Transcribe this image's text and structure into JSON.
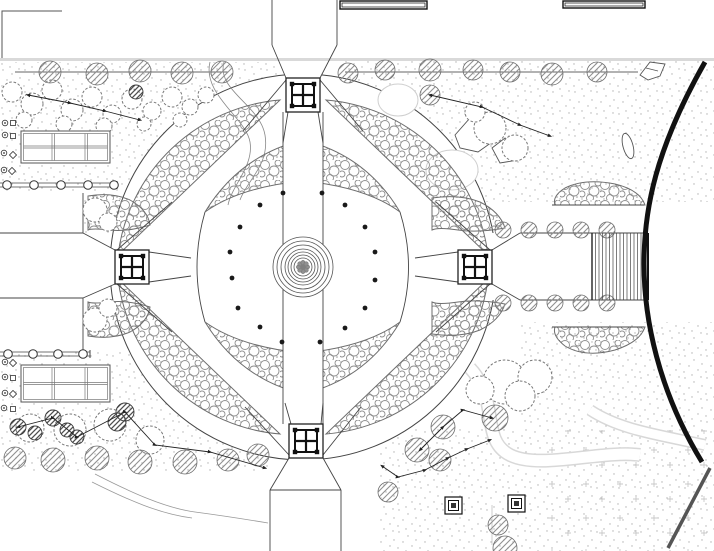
{
  "canvas": {
    "width": 714,
    "height": 551,
    "background": "#ffffff"
  },
  "palette": {
    "line": "#333333",
    "path_edge": "#444444",
    "veg_stroke": "#6e6e6e",
    "veg_circle": "#8f8f8f",
    "stipple": "#b0b0b0",
    "road": "#111111",
    "wall_gray": "#d9d9d9",
    "dark": "#1a1a1a",
    "cloud_stroke": "#787878"
  },
  "fountain": {
    "cx": 303,
    "cy": 267,
    "rings": [
      30,
      26,
      22,
      18,
      15,
      12,
      9
    ],
    "core_r": 4.5,
    "core_dot_r": 2.2
  },
  "plaza_dots": [
    [
      283,
      193
    ],
    [
      260,
      205
    ],
    [
      240,
      227
    ],
    [
      230,
      252
    ],
    [
      232,
      278
    ],
    [
      238,
      308
    ],
    [
      260,
      327
    ],
    [
      282,
      342
    ],
    [
      322,
      193
    ],
    [
      345,
      205
    ],
    [
      365,
      227
    ],
    [
      375,
      252
    ],
    [
      375,
      280
    ],
    [
      365,
      308
    ],
    [
      345,
      328
    ],
    [
      320,
      342
    ]
  ],
  "pavilions": [
    {
      "cx": 303,
      "cy": 95
    },
    {
      "cx": 132,
      "cy": 267
    },
    {
      "cx": 475,
      "cy": 267
    },
    {
      "cx": 306,
      "cy": 441
    }
  ],
  "pavilion_size": 34,
  "pergolas": [
    {
      "x": 21,
      "y": 131,
      "w": 89,
      "h": 32
    },
    {
      "x": 21,
      "y": 365,
      "w": 89,
      "h": 37
    }
  ],
  "colonnades": [
    {
      "y": 183,
      "x0": 0,
      "x1": 117,
      "posts": [
        7,
        34,
        61,
        88,
        114
      ]
    },
    {
      "y": 352,
      "x0": 0,
      "x1": 90,
      "posts": [
        8,
        33,
        58,
        83
      ]
    }
  ],
  "top_structures": [
    {
      "x": 340,
      "y": 1,
      "w": 87,
      "h": 8
    },
    {
      "x": 563,
      "y": 1,
      "w": 82,
      "h": 7
    }
  ],
  "planters": [
    {
      "x": 445,
      "y": 497,
      "s": 17
    },
    {
      "x": 508,
      "y": 495,
      "s": 17
    }
  ],
  "stairs": {
    "x0": 592,
    "x1": 648,
    "y0": 233,
    "y1": 300,
    "step": 3.5
  },
  "trees": [
    [
      50,
      72,
      11
    ],
    [
      97,
      74,
      11
    ],
    [
      140,
      71,
      11
    ],
    [
      182,
      73,
      11
    ],
    [
      222,
      72,
      11
    ],
    [
      348,
      73,
      10
    ],
    [
      385,
      70,
      10
    ],
    [
      430,
      70,
      11
    ],
    [
      473,
      70,
      10
    ],
    [
      510,
      72,
      10
    ],
    [
      552,
      74,
      11
    ],
    [
      597,
      72,
      10
    ],
    [
      430,
      95,
      10
    ],
    [
      503,
      230,
      8
    ],
    [
      529,
      230,
      8
    ],
    [
      555,
      230,
      8
    ],
    [
      581,
      230,
      8
    ],
    [
      607,
      230,
      8
    ],
    [
      503,
      303,
      8
    ],
    [
      529,
      303,
      8
    ],
    [
      555,
      303,
      8
    ],
    [
      581,
      303,
      8
    ],
    [
      607,
      303,
      8
    ],
    [
      15,
      458,
      11
    ],
    [
      53,
      460,
      12
    ],
    [
      97,
      458,
      12
    ],
    [
      140,
      462,
      12
    ],
    [
      185,
      462,
      12
    ],
    [
      228,
      460,
      11
    ],
    [
      258,
      455,
      11
    ],
    [
      388,
      492,
      10
    ],
    [
      498,
      525,
      10
    ],
    [
      505,
      548,
      12
    ],
    [
      495,
      418,
      13
    ],
    [
      443,
      427,
      12
    ],
    [
      417,
      450,
      12
    ],
    [
      440,
      460,
      11
    ]
  ],
  "dark_trees": [
    [
      136,
      92,
      7
    ],
    [
      18,
      427,
      8
    ],
    [
      35,
      433,
      7
    ],
    [
      53,
      418,
      8
    ],
    [
      67,
      430,
      7
    ],
    [
      77,
      437,
      7
    ],
    [
      117,
      422,
      9
    ],
    [
      125,
      412,
      9
    ]
  ],
  "clouds": [
    [
      12,
      92,
      10
    ],
    [
      32,
      104,
      11
    ],
    [
      52,
      90,
      10
    ],
    [
      72,
      110,
      11
    ],
    [
      92,
      97,
      10
    ],
    [
      112,
      114,
      9
    ],
    [
      132,
      99,
      10
    ],
    [
      152,
      111,
      9
    ],
    [
      172,
      97,
      10
    ],
    [
      190,
      107,
      8
    ],
    [
      206,
      95,
      8
    ],
    [
      24,
      120,
      8
    ],
    [
      64,
      124,
      8
    ],
    [
      104,
      126,
      8
    ],
    [
      144,
      124,
      7
    ],
    [
      180,
      120,
      7
    ],
    [
      95,
      210,
      12
    ],
    [
      108,
      222,
      9
    ],
    [
      95,
      320,
      12
    ],
    [
      108,
      308,
      9
    ],
    [
      490,
      128,
      16
    ],
    [
      515,
      148,
      13
    ],
    [
      475,
      112,
      10
    ],
    [
      505,
      382,
      22
    ],
    [
      535,
      377,
      17
    ],
    [
      480,
      390,
      14
    ],
    [
      520,
      396,
      15
    ],
    [
      30,
      428,
      14
    ],
    [
      70,
      430,
      16
    ],
    [
      110,
      425,
      16
    ],
    [
      150,
      440,
      14
    ]
  ],
  "chains": [
    [
      [
        28,
        95
      ],
      [
        70,
        103
      ],
      [
        105,
        111
      ],
      [
        140,
        120
      ]
    ],
    [
      [
        430,
        95
      ],
      [
        482,
        107
      ],
      [
        520,
        125
      ],
      [
        550,
        136
      ]
    ],
    [
      [
        18,
        427
      ],
      [
        53,
        418
      ],
      [
        77,
        437
      ],
      [
        125,
        412
      ],
      [
        155,
        445
      ],
      [
        210,
        452
      ],
      [
        265,
        468
      ]
    ],
    [
      [
        382,
        466
      ],
      [
        398,
        477
      ],
      [
        425,
        470
      ],
      [
        448,
        458
      ],
      [
        467,
        449
      ],
      [
        490,
        440
      ]
    ],
    [
      [
        420,
        450
      ],
      [
        443,
        427
      ],
      [
        463,
        410
      ],
      [
        492,
        418
      ]
    ]
  ],
  "symbols": [
    {
      "t": "flower",
      "x": 5,
      "y": 123
    },
    {
      "t": "square",
      "x": 13,
      "y": 123
    },
    {
      "t": "flower",
      "x": 5,
      "y": 135
    },
    {
      "t": "square",
      "x": 13,
      "y": 136
    },
    {
      "t": "flower",
      "x": 4,
      "y": 153
    },
    {
      "t": "diamond",
      "x": 13,
      "y": 155
    },
    {
      "t": "flower",
      "x": 4,
      "y": 170
    },
    {
      "t": "diamond",
      "x": 12,
      "y": 171
    },
    {
      "t": "flower",
      "x": 5,
      "y": 362
    },
    {
      "t": "diamond",
      "x": 13,
      "y": 363
    },
    {
      "t": "flower",
      "x": 5,
      "y": 377
    },
    {
      "t": "square",
      "x": 13,
      "y": 378
    },
    {
      "t": "flower",
      "x": 5,
      "y": 393
    },
    {
      "t": "diamond",
      "x": 13,
      "y": 394
    },
    {
      "t": "flower",
      "x": 4,
      "y": 408
    },
    {
      "t": "square",
      "x": 13,
      "y": 409
    }
  ],
  "road": {
    "d": "M705,62 C655,150 644,210 644,264 C644,318 658,390 702,462",
    "width": 5
  },
  "diag_line": {
    "x1": 710,
    "y1": 468,
    "x2": 668,
    "y2": 548,
    "width": 3.5
  }
}
